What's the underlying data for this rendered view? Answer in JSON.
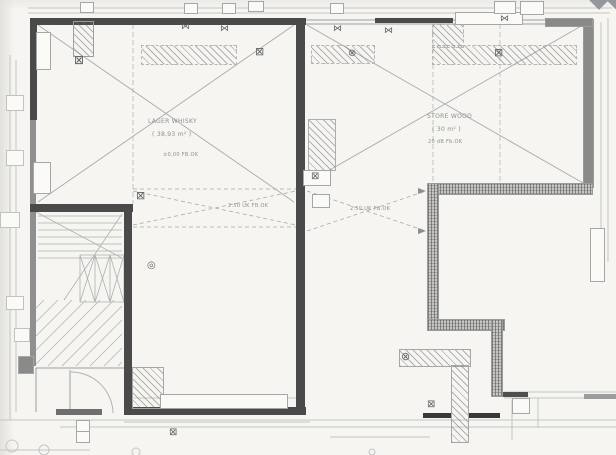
{
  "document": {
    "kind": "scanned architectural floor plan"
  },
  "colors": {
    "paper": "#f6f5f1",
    "wall_dark": "#4a4a4a",
    "wall_gray": "#8f8f8f",
    "wall_hatched": "#c6c6c4",
    "linework": "#a8acaa",
    "linework_light": "#c3c6c3"
  },
  "rooms": {
    "left_hall": {
      "name": "LAGER WHISKY",
      "area": "( 38,93 m² )",
      "note": "±0,00 FB.OK"
    },
    "right_hall": {
      "name": "STORE WOOD",
      "area": "( 30 m² )",
      "note": "20 dB Fb.OK"
    }
  },
  "annotations": {
    "beam_note_left": "2.50 UK FB.OK",
    "beam_note_right": "2.50 UK FB.OK"
  },
  "glyphs": {
    "bowtie_vent": "⋈",
    "box_x": "⊠",
    "circle_x": "⊗",
    "drain_circle": "◎"
  }
}
